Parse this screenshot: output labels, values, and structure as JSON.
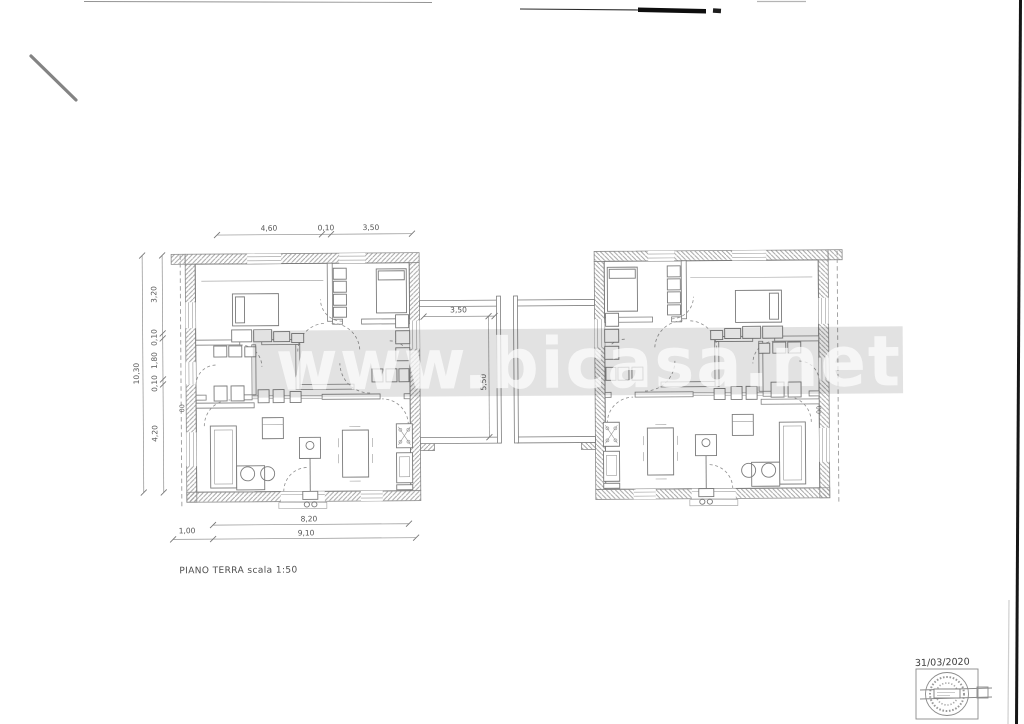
{
  "document": {
    "kind": "scanned architectural floor plan",
    "title": "PIANO TERRA scala 1:50",
    "watermark": "www.bicasa.net",
    "date": "31/03/2020"
  },
  "dimensions": {
    "top": [
      "4,60",
      "0,10",
      "3,50"
    ],
    "left_chain": [
      "3,20",
      "0,10",
      "1,80",
      "0,10",
      "4,20"
    ],
    "left_total": "10,30",
    "bottom_left": "1,00",
    "bottom_inner": "8,20",
    "bottom_total": "9,10",
    "corridor_width": "3,50",
    "corridor_depth": "5,50",
    "boundary_left": "00",
    "boundary_right": "00"
  },
  "colors": {
    "paper": "#ffffff",
    "ink": "#7a7a7a",
    "watermark_band": "#e0e0e0",
    "scan_artifact": "#111111"
  }
}
